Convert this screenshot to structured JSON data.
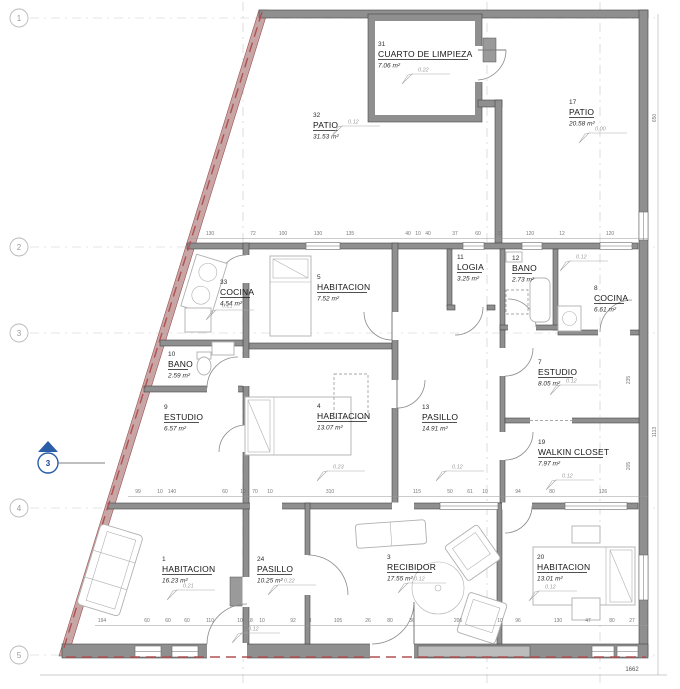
{
  "drawing_type": "architectural-floor-plan",
  "rooms": [
    {
      "number": "31",
      "name": "CUARTO DE LIMPIEZA",
      "area": "7.06 m²",
      "x": 378,
      "y": 46
    },
    {
      "number": "32",
      "name": "PATIO",
      "area": "31.53 m²",
      "x": 313,
      "y": 117
    },
    {
      "number": "17",
      "name": "PATIO",
      "area": "20.58 m²",
      "x": 569,
      "y": 104
    },
    {
      "number": "33",
      "name": "COCINA",
      "area": "4.54 m²",
      "x": 220,
      "y": 284
    },
    {
      "number": "5",
      "name": "HABITACION",
      "area": "7.52 m²",
      "x": 317,
      "y": 279
    },
    {
      "number": "11",
      "name": "LOGIA",
      "area": "3.25 m²",
      "x": 457,
      "y": 259
    },
    {
      "number": "12",
      "name": "BANO",
      "area": "2.73 m²",
      "x": 512,
      "y": 260
    },
    {
      "number": "8",
      "name": "COCINA",
      "area": "6.61 m²",
      "x": 594,
      "y": 290
    },
    {
      "number": "10",
      "name": "BANO",
      "area": "2.59 m²",
      "x": 168,
      "y": 356
    },
    {
      "number": "7",
      "name": "ESTUDIO",
      "area": "8.05 m²",
      "x": 538,
      "y": 364
    },
    {
      "number": "9",
      "name": "ESTUDIO",
      "area": "6.57 m²",
      "x": 164,
      "y": 409
    },
    {
      "number": "4",
      "name": "HABITACION",
      "area": "13.07 m²",
      "x": 317,
      "y": 408
    },
    {
      "number": "13",
      "name": "PASILLO",
      "area": "14.91 m²",
      "x": 422,
      "y": 409
    },
    {
      "number": "19",
      "name": "WALKIN CLOSET",
      "area": "7.97 m²",
      "x": 538,
      "y": 444
    },
    {
      "number": "1",
      "name": "HABITACION",
      "area": "16.23 m²",
      "x": 162,
      "y": 561
    },
    {
      "number": "24",
      "name": "PASILLO",
      "area": "10.25 m²",
      "x": 257,
      "y": 561
    },
    {
      "number": "3",
      "name": "RECIBIDOR",
      "area": "17.55 m²",
      "x": 387,
      "y": 559
    },
    {
      "number": "20",
      "name": "HABITACION",
      "area": "13.01 m²",
      "x": 537,
      "y": 559
    }
  ],
  "grid_markers": [
    {
      "label": "1",
      "y": 18
    },
    {
      "label": "2",
      "y": 247
    },
    {
      "label": "3",
      "y": 333
    },
    {
      "label": "4",
      "y": 508
    },
    {
      "label": "5",
      "y": 655
    }
  ],
  "section_marker": {
    "label": "3",
    "x": 48,
    "y": 463,
    "leader_x2": 105,
    "color": "#2b5ea7"
  },
  "level_markers": [
    {
      "value": "0.22",
      "x": 418,
      "y": 70
    },
    {
      "value": "0.12",
      "x": 348,
      "y": 122
    },
    {
      "value": "0.00",
      "x": 595,
      "y": 129
    },
    {
      "value": "0.12",
      "x": 576,
      "y": 257
    },
    {
      "value": "0.21",
      "x": 222,
      "y": 306
    },
    {
      "value": "0.12",
      "x": 566,
      "y": 381
    },
    {
      "value": "0.12",
      "x": 562,
      "y": 476
    },
    {
      "value": "0.23",
      "x": 333,
      "y": 467
    },
    {
      "value": "0.12",
      "x": 452,
      "y": 467
    },
    {
      "value": "0.21",
      "x": 183,
      "y": 586
    },
    {
      "value": "0.22",
      "x": 284,
      "y": 581
    },
    {
      "value": "0.12",
      "x": 414,
      "y": 579
    },
    {
      "value": "0.12",
      "x": 545,
      "y": 587
    },
    {
      "value": "0.12",
      "x": 248,
      "y": 629
    }
  ],
  "dimension_rows": [
    {
      "y": 235,
      "line": {
        "x1": 190,
        "x2": 648,
        "y": 238.5
      },
      "items": [
        {
          "x": 210,
          "v": "130"
        },
        {
          "x": 253,
          "v": "72"
        },
        {
          "x": 283,
          "v": "100"
        },
        {
          "x": 318,
          "v": "130"
        },
        {
          "x": 350,
          "v": "135"
        },
        {
          "x": 408,
          "v": "40"
        },
        {
          "x": 418,
          "v": "10"
        },
        {
          "x": 428,
          "v": "40"
        },
        {
          "x": 455,
          "v": "37"
        },
        {
          "x": 478,
          "v": "60"
        },
        {
          "x": 500,
          "v": "32"
        },
        {
          "x": 530,
          "v": "120"
        },
        {
          "x": 562,
          "v": "12"
        },
        {
          "x": 610,
          "v": "120"
        }
      ]
    },
    {
      "y": 493,
      "line": {
        "x1": 128,
        "x2": 648,
        "y": 496.5
      },
      "items": [
        {
          "x": 138,
          "v": "99"
        },
        {
          "x": 160,
          "v": "10"
        },
        {
          "x": 172,
          "v": "140"
        },
        {
          "x": 225,
          "v": "60"
        },
        {
          "x": 243,
          "v": "10"
        },
        {
          "x": 255,
          "v": "70"
        },
        {
          "x": 270,
          "v": "10"
        },
        {
          "x": 330,
          "v": "310"
        },
        {
          "x": 417,
          "v": "115"
        },
        {
          "x": 450,
          "v": "50"
        },
        {
          "x": 470,
          "v": "61"
        },
        {
          "x": 485,
          "v": "10"
        },
        {
          "x": 518,
          "v": "94"
        },
        {
          "x": 552,
          "v": "80"
        },
        {
          "x": 603,
          "v": "126"
        }
      ]
    },
    {
      "y": 622,
      "line": {
        "x1": 95,
        "x2": 648,
        "y": 625.5
      },
      "items": [
        {
          "x": 102,
          "v": "194"
        },
        {
          "x": 147,
          "v": "60"
        },
        {
          "x": 168,
          "v": "60"
        },
        {
          "x": 187,
          "v": "60"
        },
        {
          "x": 210,
          "v": "110"
        },
        {
          "x": 240,
          "v": "10"
        },
        {
          "x": 250,
          "v": "18"
        },
        {
          "x": 262,
          "v": "10"
        },
        {
          "x": 293,
          "v": "92"
        },
        {
          "x": 310,
          "v": "8"
        },
        {
          "x": 338,
          "v": "105"
        },
        {
          "x": 368,
          "v": "26"
        },
        {
          "x": 390,
          "v": "80"
        },
        {
          "x": 412,
          "v": "36"
        },
        {
          "x": 458,
          "v": "206"
        },
        {
          "x": 500,
          "v": "10"
        },
        {
          "x": 518,
          "v": "96"
        },
        {
          "x": 558,
          "v": "130"
        },
        {
          "x": 588,
          "v": "47"
        },
        {
          "x": 612,
          "v": "80"
        },
        {
          "x": 632,
          "v": "27"
        }
      ]
    }
  ],
  "right_dims": [
    {
      "value": "650",
      "x": 656,
      "y": 118
    },
    {
      "value": "1113",
      "x": 656,
      "y": 432
    },
    {
      "value": "235",
      "x": 630,
      "y": 380
    },
    {
      "value": "205",
      "x": 630,
      "y": 466
    }
  ],
  "total_dim": {
    "value": "1662",
    "x": 632,
    "y": 671,
    "line": {
      "x1": 40,
      "x2": 667,
      "y": 675
    }
  }
}
